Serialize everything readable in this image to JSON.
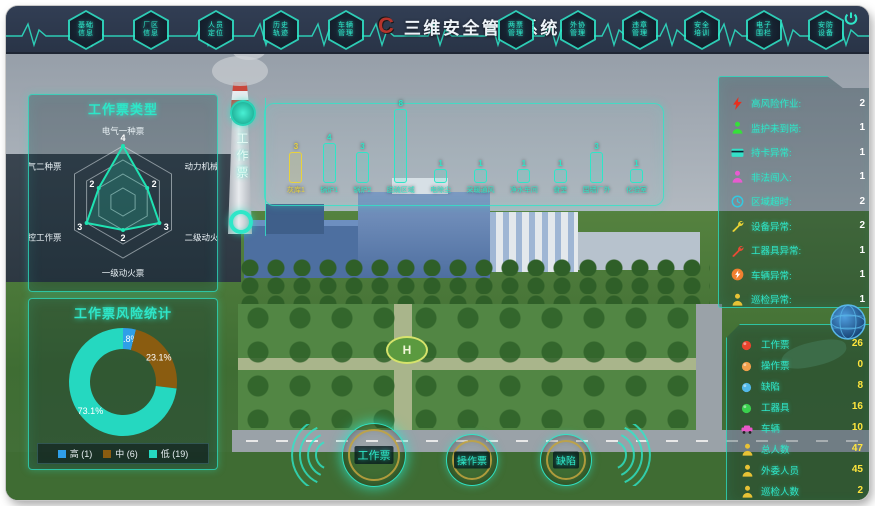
{
  "topbar": {
    "logo": "C",
    "title": "三维安全管控系统",
    "left_menu": [
      "基础信息",
      "厂区信息",
      "人员定位",
      "历史轨迹",
      "车辆管理"
    ],
    "right_menu": [
      "两票管理",
      "外协管理",
      "违章管理",
      "安全培训",
      "电子围栏",
      "安防设备"
    ]
  },
  "left_tab": {
    "label": "工作票"
  },
  "chart_data": [
    {
      "type": "radar",
      "title": "工作票类型",
      "categories": [
        "电气一种票",
        "动力机械票",
        "二级动火票",
        "一级动火票",
        "热控工作票",
        "电气二种票"
      ],
      "values": [
        4,
        2,
        3,
        2,
        3,
        2
      ],
      "max": 4,
      "grid": true,
      "line_color": "#1fe3b3"
    },
    {
      "type": "donut",
      "title": "工作票风险统计",
      "slices": [
        {
          "label": "高",
          "count": 1,
          "percent": "3.8%",
          "color": "#2f9fe8"
        },
        {
          "label": "中",
          "count": 6,
          "percent": "23.1%",
          "color": "#8a5c10"
        },
        {
          "label": "低",
          "count": 19,
          "percent": "73.1%",
          "color": "#25d8c0"
        }
      ],
      "legend": [
        "高 (1)",
        "中 (6)",
        "低 (19)"
      ],
      "legend_position": "bottom"
    },
    {
      "type": "bar",
      "categories": [
        "灰库1",
        "锅炉1",
        "锅炉2",
        "脱硫区域",
        "电除尘",
        "采暖通风",
        "净水车间",
        "食堂",
        "围墙厂外",
        "化验室"
      ],
      "values": [
        3,
        4,
        3,
        8,
        1,
        1,
        1,
        1,
        3,
        1
      ],
      "colors": [
        "#e8d23c",
        "#2ee6c8",
        "#2ee6c8",
        "#2ee6c8",
        "#2ee6c8",
        "#2ee6c8",
        "#2ee6c8",
        "#2ee6c8",
        "#2ee6c8",
        "#2ee6c8"
      ]
    }
  ],
  "alert_panel": {
    "items": [
      {
        "icon": "lightning-icon",
        "color": "#e8301e",
        "label": "高风险作业:",
        "value": 2
      },
      {
        "icon": "person-icon",
        "color": "#35e03a",
        "label": "监护未到岗:",
        "value": 1
      },
      {
        "icon": "card-icon",
        "color": "#35e0c8",
        "label": "持卡异常:",
        "value": 1
      },
      {
        "icon": "person-icon",
        "color": "#e85bd0",
        "label": "非法闯入:",
        "value": 1
      },
      {
        "icon": "clock-icon",
        "color": "#35c8e0",
        "label": "区域超时:",
        "value": 2
      },
      {
        "icon": "wrench-icon",
        "color": "#e8d235",
        "label": "设备异常:",
        "value": 2
      },
      {
        "icon": "wrench-icon",
        "color": "#e84b35",
        "label": "工器具异常:",
        "value": 1
      },
      {
        "icon": "warning-icon",
        "color": "#f08030",
        "label": "车辆异常:",
        "value": 1
      },
      {
        "icon": "person-icon",
        "color": "#e8c235",
        "label": "巡检异常:",
        "value": 1
      }
    ]
  },
  "stats_panel": {
    "items": [
      {
        "icon": "dot-icon",
        "color": "#e8442e",
        "label": "工作票",
        "value": 26
      },
      {
        "icon": "dot-icon",
        "color": "#f0a04c",
        "label": "操作票",
        "value": 0
      },
      {
        "icon": "dot-icon",
        "color": "#52b8e8",
        "label": "缺陷",
        "value": 8
      },
      {
        "icon": "dot-icon",
        "color": "#3ad04e",
        "label": "工器具",
        "value": 16
      },
      {
        "icon": "car-icon",
        "color": "#e858c8",
        "label": "车辆",
        "value": 10
      },
      {
        "icon": "person-icon",
        "color": "#e8c235",
        "label": "总人数",
        "value": 47
      },
      {
        "icon": "person-icon",
        "color": "#e8c235",
        "label": "外委人员",
        "value": 45
      },
      {
        "icon": "person-icon",
        "color": "#e8c235",
        "label": "巡检人数",
        "value": 2
      }
    ]
  },
  "bottom_buttons": [
    {
      "label": "工作票",
      "active": true
    },
    {
      "label": "操作票",
      "active": false
    },
    {
      "label": "缺陷",
      "active": false
    }
  ],
  "colors": {
    "accent": "#2ee6c8",
    "value_yellow": "#ffe53d",
    "logo_red": "#b5342c"
  }
}
